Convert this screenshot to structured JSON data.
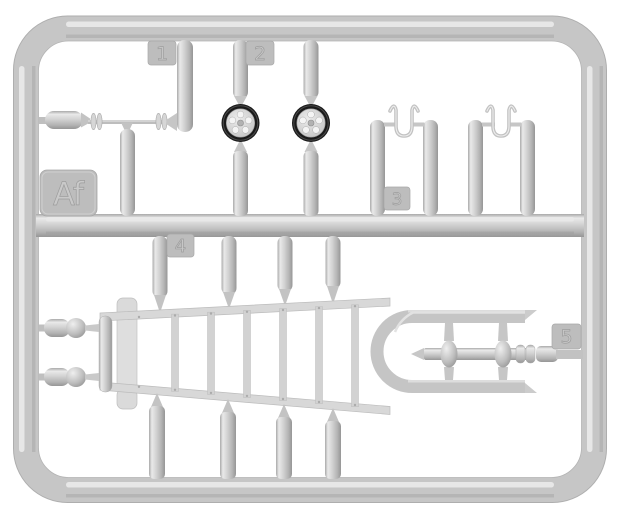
{
  "scene": {
    "type": "injection-molded-sprue",
    "frame_code": "Af",
    "tags": [
      {
        "label": "1"
      },
      {
        "label": "2"
      },
      {
        "label": "3"
      },
      {
        "label": "4"
      },
      {
        "label": "5"
      }
    ],
    "parts": [
      {
        "tag": "1",
        "name": "tapered-rod-with-spool-flanges",
        "count": 1
      },
      {
        "tag": "2",
        "name": "road-wheel-black-tire-five-holes",
        "count": 2
      },
      {
        "tag": "3",
        "name": "v-shaped-wire-hook",
        "count": 2
      },
      {
        "tag": "4",
        "name": "cylindrical-bow-pole",
        "count": 8
      },
      {
        "tag": "5",
        "name": "axle-with-twin-spindles",
        "count": 1
      },
      {
        "name": "trapezoid-ladder-frame",
        "count": 1
      },
      {
        "name": "ball-tipped-cylinder",
        "count": 2
      }
    ],
    "colors": {
      "background": "#ffffff",
      "plastic": "#c7c7c7",
      "plastic_highlight": "#eaeaea",
      "plastic_shadow": "#a0a0a0",
      "tag_fill": "#bababa",
      "tire": "#1a1a1a"
    }
  }
}
